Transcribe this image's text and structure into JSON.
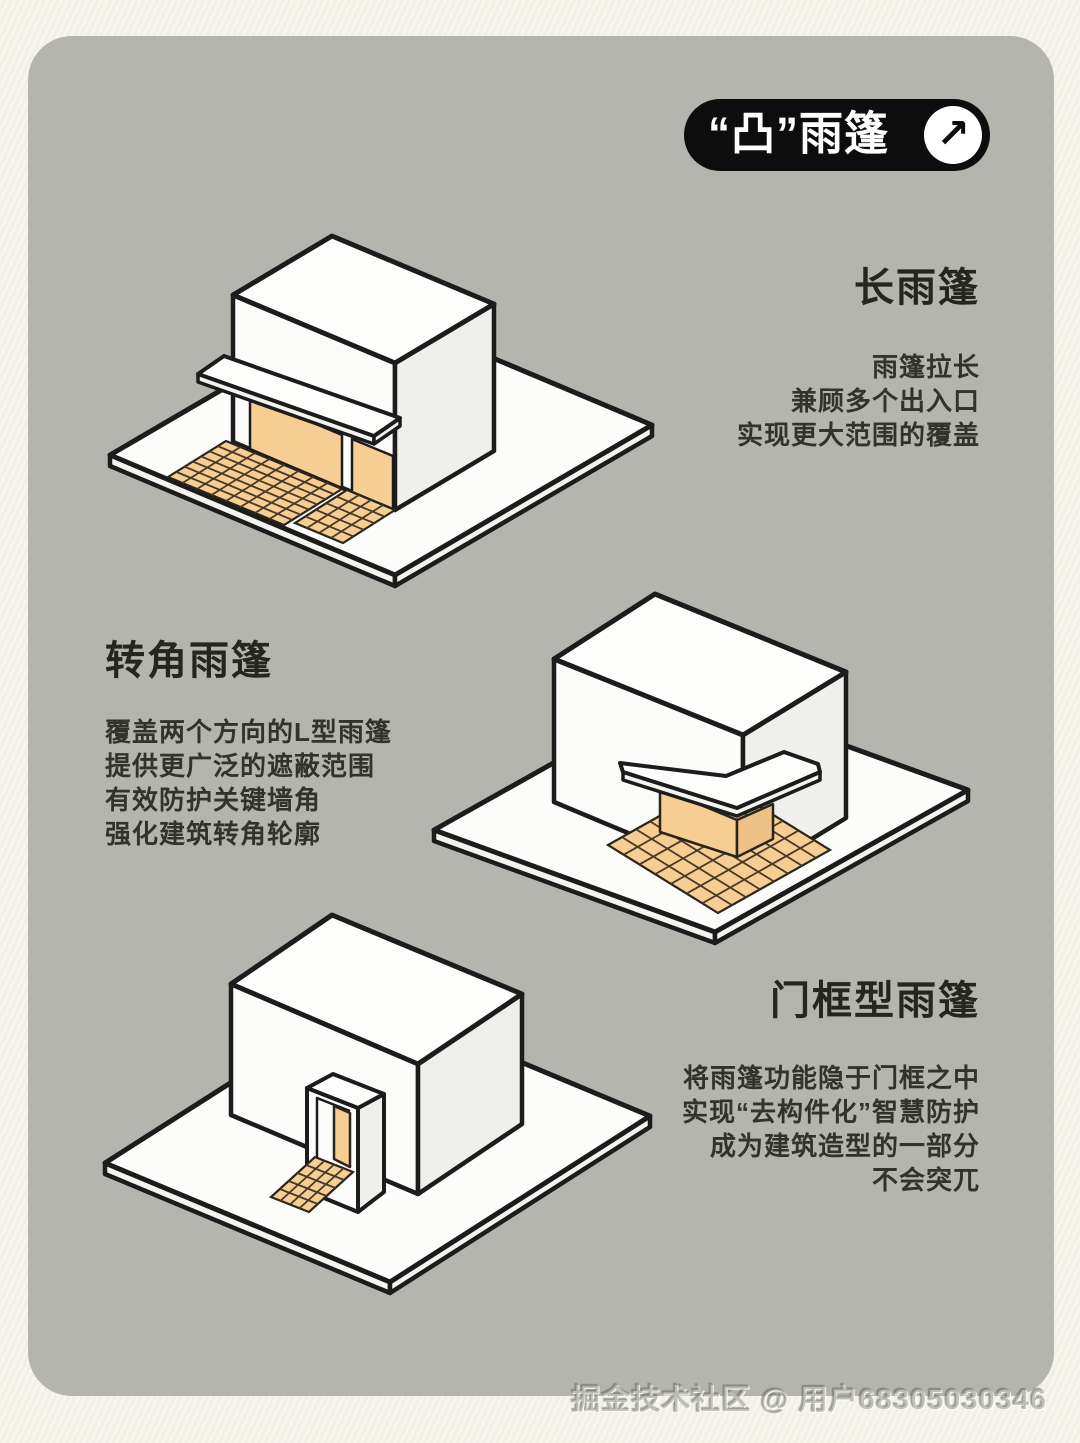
{
  "colors": {
    "page_bg": "#f4f2e9",
    "card_bg": "#b4b5af",
    "outline": "#1c1c1c",
    "accent_orange": "#f6cd92",
    "tile_line": "#473928",
    "tile_edge": "#2a241a",
    "face_white": "#fbfbf9",
    "face_top": "#fdfdfc",
    "face_shade": "#efefeb",
    "platform_side": "#f3f3ef",
    "badge_bg": "#0d0d0d",
    "badge_fg": "#ffffff",
    "text": "#2e2d2a"
  },
  "badge": {
    "label": "“凸”雨篷",
    "arrow_icon": "↗"
  },
  "sections": [
    {
      "id": "long",
      "title": "长雨篷",
      "lines": [
        "雨篷拉长",
        "兼顾多个出入口",
        "实现更大范围的覆盖"
      ]
    },
    {
      "id": "corner",
      "title": "转角雨篷",
      "lines": [
        "覆盖两个方向的L型雨篷",
        "提供更广泛的遮蔽范围",
        "有效防护关键墙角",
        "强化建筑转角轮廓"
      ]
    },
    {
      "id": "doorframe",
      "title": "门框型雨篷",
      "lines": [
        "将雨篷功能隐于门框之中",
        "实现“去构件化”智慧防护",
        "成为建筑造型的一部分",
        "不会突兀"
      ]
    }
  ],
  "illustrations": [
    {
      "name": "long-canopy-building"
    },
    {
      "name": "corner-canopy-building"
    },
    {
      "name": "doorframe-canopy-building"
    }
  ],
  "watermark": {
    "text": "掘金技术社区 @ 用户68305030346"
  }
}
